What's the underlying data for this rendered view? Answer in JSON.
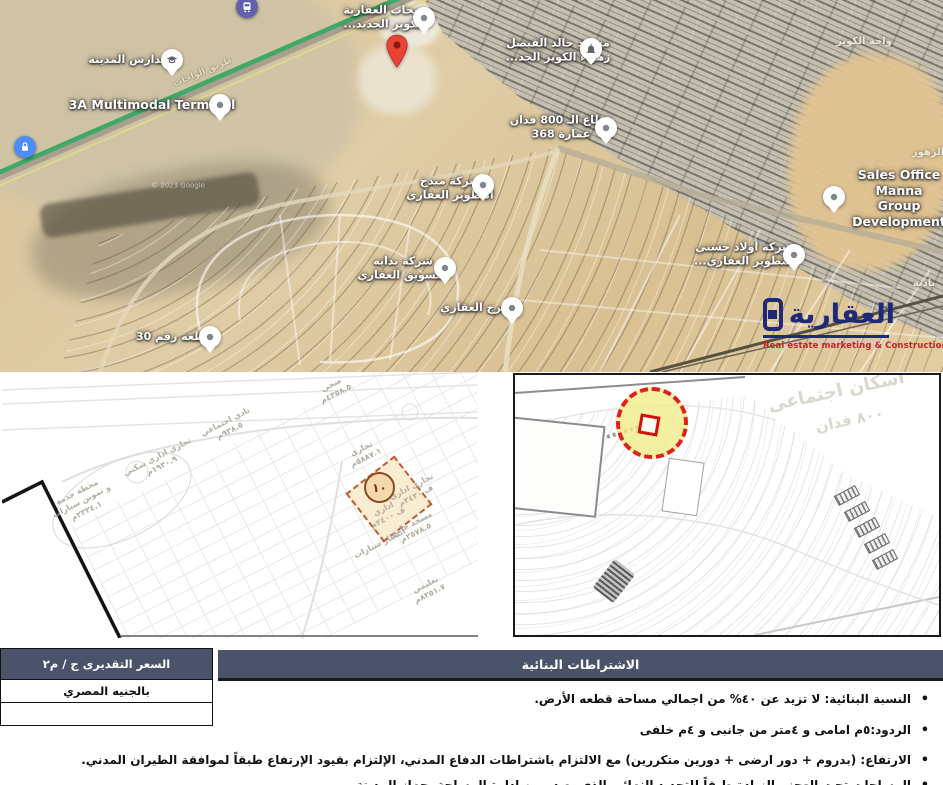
{
  "colors": {
    "table_header_bg": "#4a5369",
    "logo_navy": "#1e2a78",
    "logo_red": "#c4232a",
    "highway_green": "#3fa967",
    "highlight_yellow": "#efec8a",
    "highlight_red": "#e01f1f",
    "plot_fill": "#f8edd0",
    "plot_border": "#c05a35",
    "red_marker": "#e94335"
  },
  "map": {
    "pins": [
      {
        "name": "bus-station-pin",
        "icon": "bus-icon",
        "style": "purple",
        "x": 247,
        "y": 7
      },
      {
        "name": "lock-pin",
        "icon": "lock-icon",
        "style": "blue",
        "x": 25,
        "y": 147
      },
      {
        "name": "city-schools-pin",
        "icon": "graduation-cap-icon",
        "style": "white",
        "x": 172,
        "y": 60
      },
      {
        "name": "terminal-pin",
        "icon": "dot-icon",
        "style": "white",
        "x": 220,
        "y": 105
      },
      {
        "name": "sahab-realestate-pin",
        "icon": "dot-icon",
        "style": "white",
        "x": 424,
        "y": 18
      },
      {
        "name": "destination-marker",
        "icon": "red-marker-icon",
        "style": "red",
        "x": 397,
        "y": 52
      },
      {
        "name": "mosque-pin",
        "icon": "mosque-icon",
        "style": "white",
        "x": 591,
        "y": 49
      },
      {
        "name": "sector-800-pin",
        "icon": "dot-icon",
        "style": "white",
        "x": 606,
        "y": 128
      },
      {
        "name": "midg-company-pin",
        "icon": "dot-icon",
        "style": "white",
        "x": 483,
        "y": 185
      },
      {
        "name": "bedaya-company-pin",
        "icon": "dot-icon",
        "style": "white",
        "x": 445,
        "y": 268
      },
      {
        "name": "borg-company-pin",
        "icon": "dot-icon",
        "style": "white",
        "x": 512,
        "y": 308
      },
      {
        "name": "plot-30-pin",
        "icon": "dot-icon",
        "style": "white",
        "x": 210,
        "y": 337
      },
      {
        "name": "hosny-company-pin",
        "icon": "dot-icon",
        "style": "white",
        "x": 794,
        "y": 255
      },
      {
        "name": "sales-office-pin",
        "icon": "dot-icon",
        "style": "white",
        "x": 834,
        "y": 197
      }
    ],
    "labels": [
      {
        "name": "label-city-schools",
        "text": "مدارس المدينة",
        "x": 128,
        "y": 60,
        "cls": "lbl-place"
      },
      {
        "name": "label-terminal",
        "text": "3A Multimodal Terminal",
        "x": 152,
        "y": 105,
        "cls": "lbl-place lbl-en"
      },
      {
        "name": "label-sahab",
        "text": "سحاب العقارية\nالكوير الجديد...",
        "x": 384,
        "y": 17,
        "cls": "lbl-place"
      },
      {
        "name": "label-mosque",
        "text": "مسجد خالد الفيصل\nزهراء الكوير الجد...",
        "x": 558,
        "y": 50,
        "cls": "lbl-place"
      },
      {
        "name": "label-sector-800",
        "text": "قطاع الـ 800 فدان\nعمارة 368",
        "x": 561,
        "y": 127,
        "cls": "lbl-place"
      },
      {
        "name": "label-midg",
        "text": "شركة ميدج\nالتطوير العقاري",
        "x": 450,
        "y": 188,
        "cls": "lbl-place"
      },
      {
        "name": "label-bedaya",
        "text": "شركة بدايه\nالتسويق العقاري",
        "x": 403,
        "y": 268,
        "cls": "lbl-place"
      },
      {
        "name": "label-borg",
        "text": "البرج العقاري",
        "x": 477,
        "y": 308,
        "cls": "lbl-place"
      },
      {
        "name": "label-plot-30",
        "text": "قطعة رقم 30",
        "x": 174,
        "y": 337,
        "cls": "lbl-place"
      },
      {
        "name": "label-hosny",
        "text": "شركة أولاد حسني\nالتطوير العقاري...",
        "x": 744,
        "y": 254,
        "cls": "lbl-place"
      },
      {
        "name": "label-sales-office",
        "text": "Sales Office Manna\nGroup Development",
        "x": 899,
        "y": 198,
        "cls": "lbl-place lbl-en"
      },
      {
        "name": "label-waha-elkoweir",
        "text": "واحة الكوير",
        "x": 864,
        "y": 42,
        "cls": "lbl-area"
      },
      {
        "name": "label-oases-road",
        "text": "طريق الواحات",
        "x": 203,
        "y": 73,
        "cls": "lbl-road",
        "rot": -23
      },
      {
        "name": "label-zohour",
        "text": "الزهور",
        "x": 928,
        "y": 153,
        "cls": "lbl-area"
      },
      {
        "name": "label-badya",
        "text": "بادية",
        "x": 924,
        "y": 284,
        "cls": "lbl-area"
      },
      {
        "name": "label-attribution",
        "text": "© 2023 Google",
        "x": 178,
        "y": 186,
        "cls": "lbl-attr"
      }
    ]
  },
  "logo": {
    "arabic": "العقارية",
    "english": "Real estate marketing & Construction",
    "icon": "square-logo-icon"
  },
  "plans": {
    "left": {
      "plot_number": "١٠",
      "labels": [
        {
          "text": "صحي\n٤٣٥٨.٥م",
          "x": 332,
          "y": 18
        },
        {
          "text": "نادي اجتماعي\n٩٣٨.٥م",
          "x": 226,
          "y": 55
        },
        {
          "text": "تجاري اداري سكني\n١٩٣٠.٩م",
          "x": 158,
          "y": 90
        },
        {
          "text": "محطة خدمة\nو تموين سيارات\n٢٣٣٤.١م",
          "x": 80,
          "y": 130
        },
        {
          "text": "تجاري\n٥٨٨٧.١م",
          "x": 362,
          "y": 82
        },
        {
          "text": "تجاري اداري\nف ٢٤٢٠م",
          "x": 412,
          "y": 120
        },
        {
          "text": "اداري\nف ٢٤٠٠م",
          "x": 384,
          "y": 142
        },
        {
          "text": "مسجد جامع\n٢٥٧٨.٥م",
          "x": 412,
          "y": 157
        },
        {
          "text": "انتظار سيارات",
          "x": 378,
          "y": 172
        },
        {
          "text": "تعليمي\n٨٣٥١.٧م",
          "x": 426,
          "y": 218
        }
      ]
    },
    "right": {
      "faint_area_label": "اسكان اجتماعى",
      "faint_area_size": "٨٠٠ فدان"
    }
  },
  "table": {
    "price_header": "السعر التقديرى ج / م٢",
    "price_rows": [
      "بالجنيه المصري",
      ""
    ],
    "main_header": "الاشتراطات البنائية",
    "bullet_char": "•",
    "items": [
      "النسبة البنائية: لا تزيد عن ٤٠% من اجمالي مساحة قطعه الأرض.",
      "الردود:٥م امامى و ٤متر من جانبى و ٤م خلفى",
      "الارتفاع: (بدروم + دور ارضى + دورين متكررين) مع الالتزام باشتراطات الدفاع المدني، الإلتزام بقيود الإرتفاع طبقاً لموافقة الطيران المدني.",
      "المساحات تحت العجز والزيادة طبقاً للتحديد النهائى الذي يصدر من ادارة المساحة بجهاز المدينة."
    ]
  }
}
